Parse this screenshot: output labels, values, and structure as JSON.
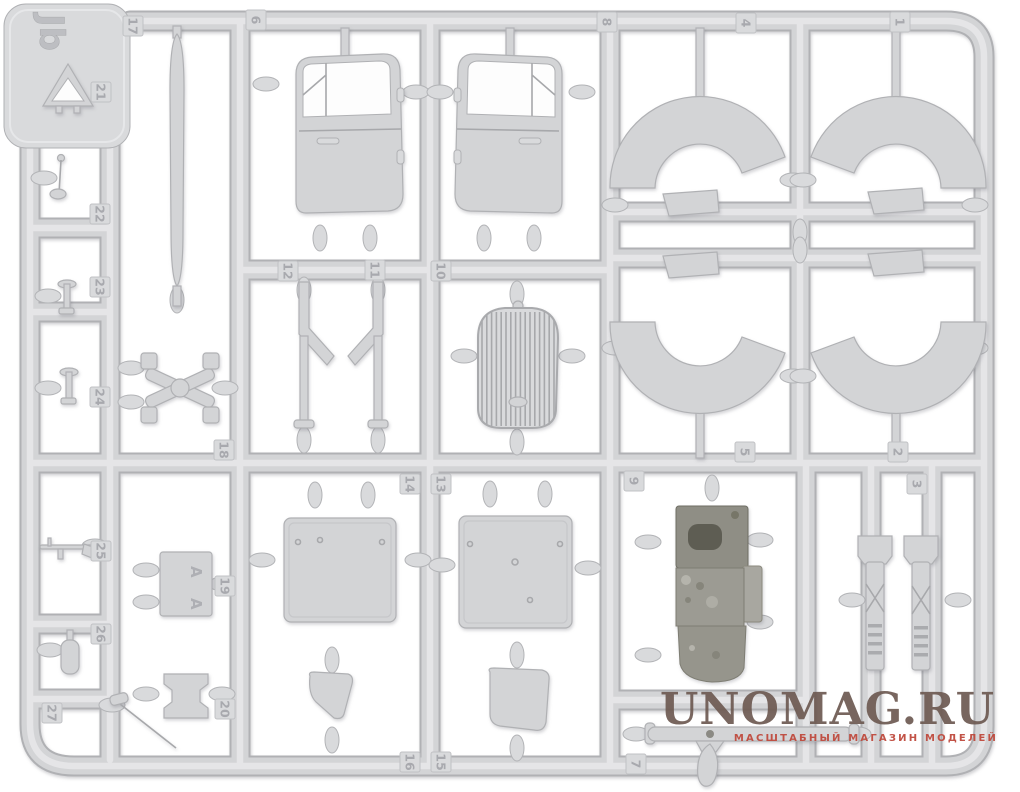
{
  "sprue_letter": "Jb",
  "part_tags": [
    {
      "n": "17",
      "x": 133,
      "y": 26
    },
    {
      "n": "6",
      "x": 256,
      "y": 20
    },
    {
      "n": "8",
      "x": 607,
      "y": 22
    },
    {
      "n": "4",
      "x": 746,
      "y": 23
    },
    {
      "n": "1",
      "x": 900,
      "y": 22
    },
    {
      "n": "21",
      "x": 101,
      "y": 92
    },
    {
      "n": "22",
      "x": 100,
      "y": 214
    },
    {
      "n": "23",
      "x": 100,
      "y": 287
    },
    {
      "n": "24",
      "x": 100,
      "y": 397
    },
    {
      "n": "25",
      "x": 101,
      "y": 551
    },
    {
      "n": "26",
      "x": 101,
      "y": 634
    },
    {
      "n": "27",
      "x": 52,
      "y": 713
    },
    {
      "n": "12",
      "x": 288,
      "y": 271
    },
    {
      "n": "11",
      "x": 375,
      "y": 270
    },
    {
      "n": "10",
      "x": 441,
      "y": 271
    },
    {
      "n": "18",
      "x": 224,
      "y": 450
    },
    {
      "n": "19",
      "x": 225,
      "y": 586
    },
    {
      "n": "20",
      "x": 225,
      "y": 709
    },
    {
      "n": "14",
      "x": 410,
      "y": 484
    },
    {
      "n": "13",
      "x": 441,
      "y": 484
    },
    {
      "n": "16",
      "x": 410,
      "y": 762
    },
    {
      "n": "15",
      "x": 441,
      "y": 762
    },
    {
      "n": "9",
      "x": 634,
      "y": 481
    },
    {
      "n": "5",
      "x": 745,
      "y": 452
    },
    {
      "n": "2",
      "x": 898,
      "y": 452
    },
    {
      "n": "3",
      "x": 917,
      "y": 484
    },
    {
      "n": "7",
      "x": 636,
      "y": 764
    }
  ],
  "clip_plate_letters": {
    "top": "A",
    "bottom": "A"
  },
  "watermark": {
    "title": "UNOMAG.RU",
    "subtitle": "МАСШТАБНЫЙ МАГАЗИН МОДЕЛЕЙ",
    "title_color": "#6d5a52",
    "subtitle_color": "#bf4a3e"
  },
  "colors": {
    "background": "#ffffff",
    "plastic": "#d3d4d6",
    "plastic_edge": "#b0b1b4",
    "plastic_highlight": "#e7e8ea",
    "tag_fill": "#d9dadc",
    "tag_text": "#a8a9ae",
    "dark_base": "#8f8e85",
    "dark_deep": "#5e5d53",
    "dark_mid": "#9c9b93"
  }
}
